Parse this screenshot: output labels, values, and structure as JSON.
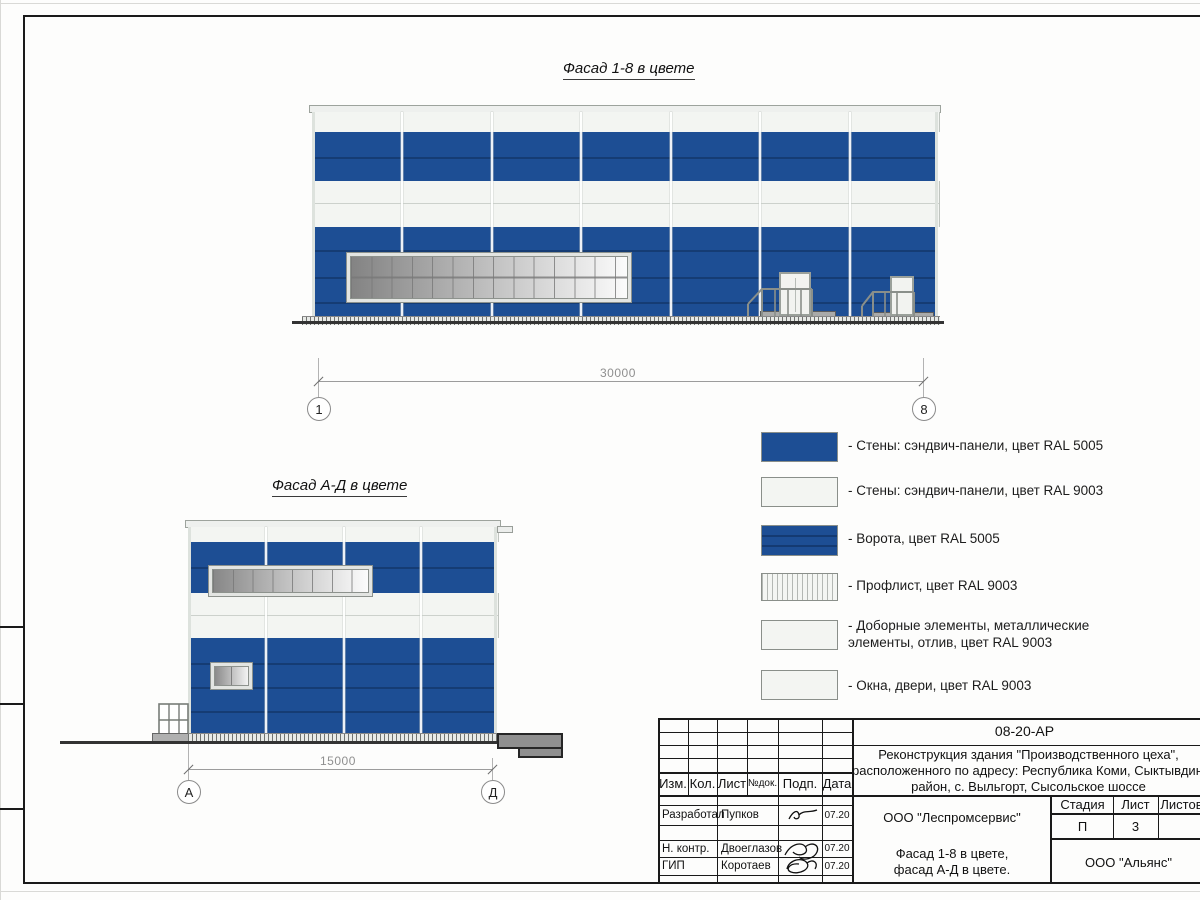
{
  "drawings": {
    "facade18": {
      "title": "Фасад 1-8 в цвете",
      "dimension": "30000",
      "axis_left": "1",
      "axis_right": "8"
    },
    "facadeAD": {
      "title": "Фасад А-Д в цвете",
      "dimension": "15000",
      "axis_left": "А",
      "axis_right": "Д"
    }
  },
  "legend": {
    "items": [
      {
        "swatch": "wall-sandwich-panel-blue",
        "label": "- Стены: сэндвич-панели, цвет RAL 5005"
      },
      {
        "swatch": "wall-sandwich-panel-white",
        "label": "- Стены: сэндвич-панели, цвет RAL 9003"
      },
      {
        "swatch": "gate-blue",
        "label": "- Ворота, цвет RAL 5005"
      },
      {
        "swatch": "profiled-sheet",
        "label": "- Профлист, цвет RAL 9003"
      },
      {
        "swatch": "trim-elements-white",
        "label": "- Доборные элементы, металлические элементы, отлив, цвет RAL 9003"
      },
      {
        "swatch": "windows-doors-white",
        "label": "- Окна, двери, цвет RAL 9003"
      }
    ]
  },
  "title_block": {
    "doc_number": "08-20-АР",
    "project": {
      "l1": "Реконструкция здания \"Производственного цеха\",",
      "l2": "расположенного по адресу: Республика Коми, Сыктывдинский",
      "l3": "район, с. Выльгорт, Сысольское шоссе"
    },
    "cols": {
      "izm": "Изм.",
      "kol": "Кол.",
      "list": "Лист",
      "ndok": "№док.",
      "podp": "Подп.",
      "data": "Дата"
    },
    "rows": [
      {
        "role": "Разработал",
        "name": "Пупков",
        "date": "07.20"
      },
      {
        "role": "Н. контр.",
        "name": "Двоеглазов",
        "date": "07.20"
      },
      {
        "role": "ГИП",
        "name": "Коротаев",
        "date": "07.20"
      }
    ],
    "organization": "ООО \"Леспромсервис\"",
    "sheet_title": {
      "l1": "Фасад 1-8 в цвете,",
      "l2": "фасад А-Д в цвете."
    },
    "stage": {
      "stage_label": "Стадия",
      "list_label": "Лист",
      "listov_label": "Листов",
      "stage_value": "П",
      "list_value": "3"
    },
    "contractor": "ООО \"Альянс\""
  },
  "colors": {
    "ral5005": "#1d4e94",
    "ral9003": "#f3f5f2"
  }
}
